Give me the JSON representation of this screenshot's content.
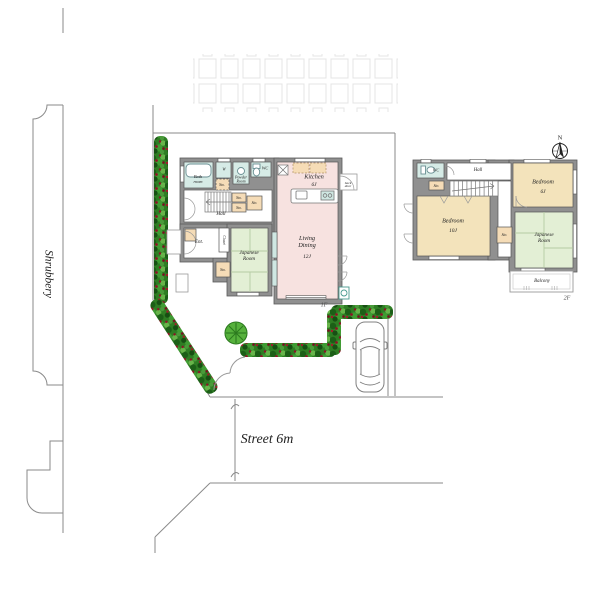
{
  "site": {
    "shrubbery": "Shrubbery",
    "street": "Street 6m",
    "north": "N"
  },
  "floor1": {
    "floor_tag": "1F",
    "bath": "Bath\nroom",
    "washer": "W",
    "powder": "Powder\nRoom",
    "wc": "WC",
    "sto": "Sto.",
    "hall": "Hall",
    "ent": "Ent.",
    "closet": "Closet",
    "japanese": "Japanese\nRoom",
    "kitchen_name": "Kitchen",
    "kitchen_size": "6J",
    "living_name": "Living\nDining",
    "living_size": "12J",
    "backdoor": "back\ndoor"
  },
  "floor2": {
    "floor_tag": "2F",
    "wc": "WC",
    "hall": "Hall",
    "sto": "Sto.",
    "bedroom_large_name": "Bedroom",
    "bedroom_large_size": "10J",
    "bedroom_small_name": "Bedroom",
    "bedroom_small_size": "6J",
    "japanese": "Japanese\nRoom",
    "balcony": "Balcony"
  },
  "colors": {
    "wall_gray": "#909090",
    "water_room_teal": "#d6ebe6",
    "ldk_pink": "#f7e2e0",
    "tatami_green": "#e3efd5",
    "bedroom_wheat": "#f3e3bb",
    "storage_tan": "#f5dcb7",
    "hedge_green": "#2e7d23",
    "hedge_berry": "#8c1426",
    "tree_green": "#56b13c"
  }
}
